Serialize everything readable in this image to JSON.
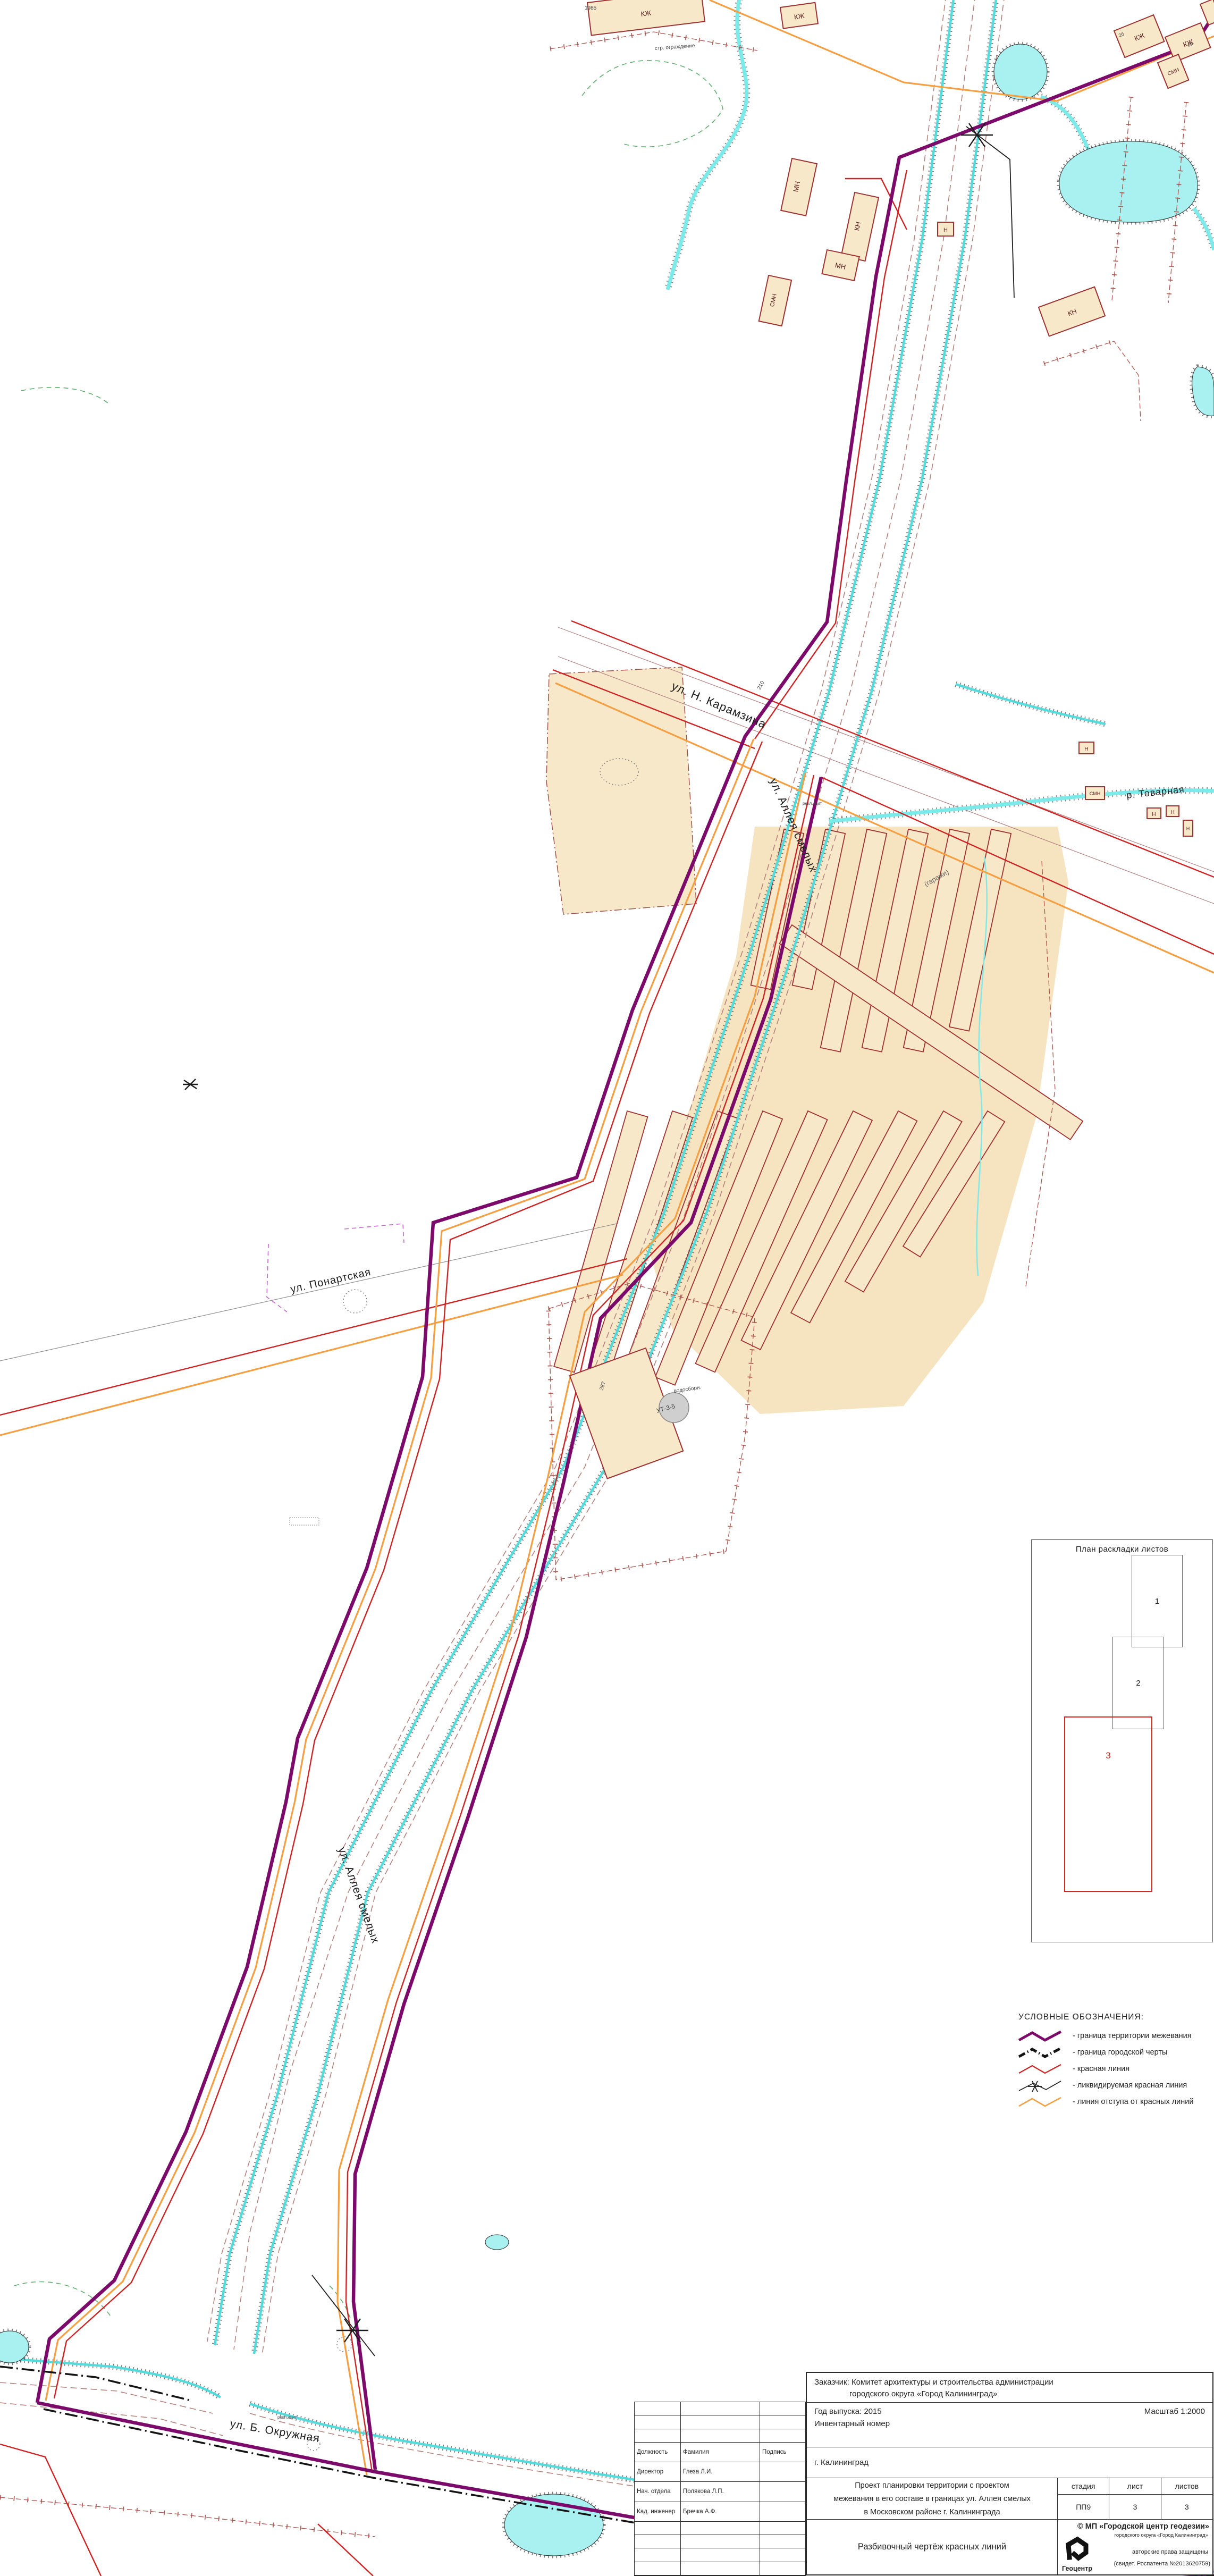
{
  "colors": {
    "boundary_purple": "#7c0a6b",
    "red_line": "#cf2222",
    "offset_orange": "#f59f43",
    "city_boundary": "#141414",
    "water": "#a9f1f0",
    "building_fill": "#f8e8ca",
    "building_stroke": "#9e3030"
  },
  "map": {
    "streets": {
      "karamzina": "ул. Н. Карамзина",
      "alleya": "ул. Аллея смелых",
      "ponartskaya": "ул. Понартская",
      "okruzhnaya": "ул. Б. Окружная",
      "tovarnaya": "р. Товарная",
      "garazhi": "(гаражи)"
    },
    "small_labels": {
      "ograzhdenie": "стр. ограждение",
      "vodosborn": "водосборн.",
      "ut": "УТ-3-5",
      "reklama": "рекл. щит",
      "n287": "287",
      "n210": "210",
      "n1985": "1985",
      "n2b": "2б",
      "n2a": "2а"
    },
    "building_types": {
      "kzh": "КЖ",
      "mn": "МН",
      "kn": "КН",
      "smn": "СМН",
      "n": "Н"
    }
  },
  "sheet_plan": {
    "title": "План раскладки листов",
    "sheets": [
      "1",
      "2",
      "3"
    ]
  },
  "legend": {
    "title": "УСЛОВНЫЕ   ОБОЗНАЧЕНИЯ:",
    "items": [
      {
        "id": "mezhevanie",
        "label": "- граница территории межевания"
      },
      {
        "id": "city-limit",
        "label": "- граница городской черты"
      },
      {
        "id": "red-line",
        "label": "- красная линия"
      },
      {
        "id": "liquidated",
        "label": "- ликвидируемая красная линия"
      },
      {
        "id": "offset",
        "label": "- линия отступа от красных линий"
      }
    ]
  },
  "title_block": {
    "customer_line1": "Заказчик: Комитет архитектуры и строительства администрации",
    "customer_line2": "городского округа «Город Калининград»",
    "year": "Год выпуска: 2015",
    "scale": "Масштаб 1:2000",
    "inventory": "Инвентарный номер",
    "city": "г. Калининград",
    "project_line1": "Проект планировки территории с проектом",
    "project_line2": "межевания в его составе в границах ул. Аллея смелых",
    "project_line3": "в Московском районе г. Калининграда",
    "stage_label": "стадия",
    "sheet_label": "лист",
    "sheets_label": "листов",
    "stage_value": "ПП9",
    "sheet_value": "3",
    "sheets_value": "3",
    "drawing_title": "Разбивочный чертёж красных линий",
    "org_line1": "© МП «Городской центр геодезии»",
    "org_line2": "городского округа «Город Калининград»",
    "org_rights": "авторские права защищены",
    "org_cert": "(свидет. Роспатента №2013620759)",
    "org_logo_text": "Геоцентр",
    "staff_headers": {
      "position": "Должность",
      "name": "Фамилия",
      "signature": "Подпись"
    },
    "staff": [
      {
        "role": "Директор",
        "name": "Глеза Л.И."
      },
      {
        "role": "Нач. отдела",
        "name": "Полякова Л.П."
      },
      {
        "role": "Кад. инженер",
        "name": "Бречка А.Ф."
      }
    ]
  }
}
